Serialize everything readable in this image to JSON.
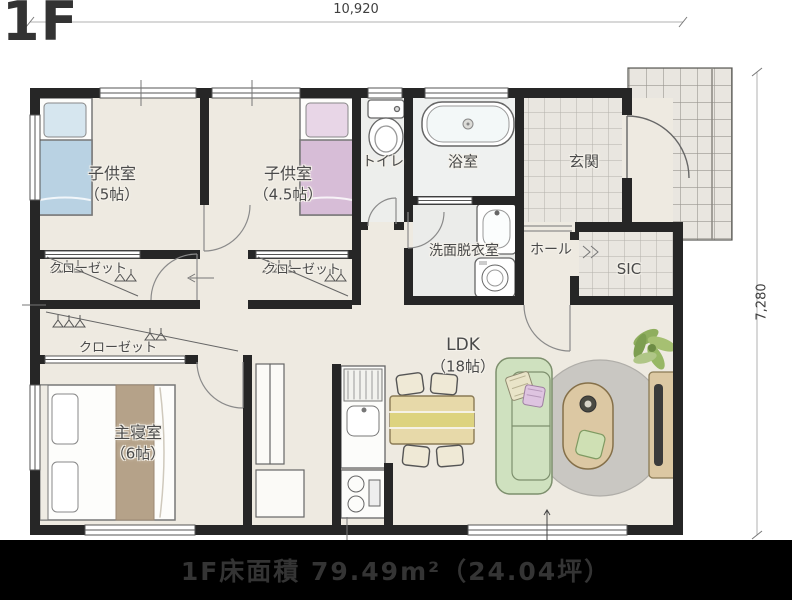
{
  "page": {
    "title": "1F",
    "caption": "1F床面積 79.49m²（24.04坪）"
  },
  "dimensions": {
    "width": "10,920",
    "height": "7,280"
  },
  "rooms": {
    "kids1": {
      "name": "子供室",
      "size": "（5帖）"
    },
    "kids2": {
      "name": "子供室",
      "size": "（4.5帖）"
    },
    "toilet": {
      "name": "トイレ"
    },
    "bath": {
      "name": "浴室"
    },
    "entrance": {
      "name": "玄関"
    },
    "washroom": {
      "name": "洗面脱衣室"
    },
    "hall": {
      "name": "ホール"
    },
    "sic": {
      "name": "SIC"
    },
    "closet1": {
      "name": "クローゼット"
    },
    "closet2": {
      "name": "クローゼット"
    },
    "closet3": {
      "name": "クローゼット"
    },
    "master": {
      "name": "主寝室",
      "size": "（6帖）"
    },
    "ldk": {
      "name": "LDK",
      "size": "（18帖）"
    }
  },
  "colors": {
    "wall": "#262626",
    "floor": "#eeeae1",
    "wet": "#edeeec",
    "tile": "#e9e6e0",
    "tile_line": "#b3b0aa",
    "bed_blue": "#b9d2e3",
    "bed_blue_light": "#d6e6ef",
    "bed_pink": "#d7bdd7",
    "bed_pink_light": "#e8d6e7",
    "bed_runner": "#b5a289",
    "sofa_green": "#cfe1bf",
    "rug_gray": "#c9c7c2",
    "wood_table": "#dcc8a3",
    "dining_yellow": "#e7d9a9",
    "dining_band": "#ddd37f",
    "tv_dark": "#3b3b3b",
    "plant_green": "#8fae5e",
    "label_text": "#4a4a4a",
    "caption_bg": "#000000",
    "caption_text": "#343434"
  }
}
